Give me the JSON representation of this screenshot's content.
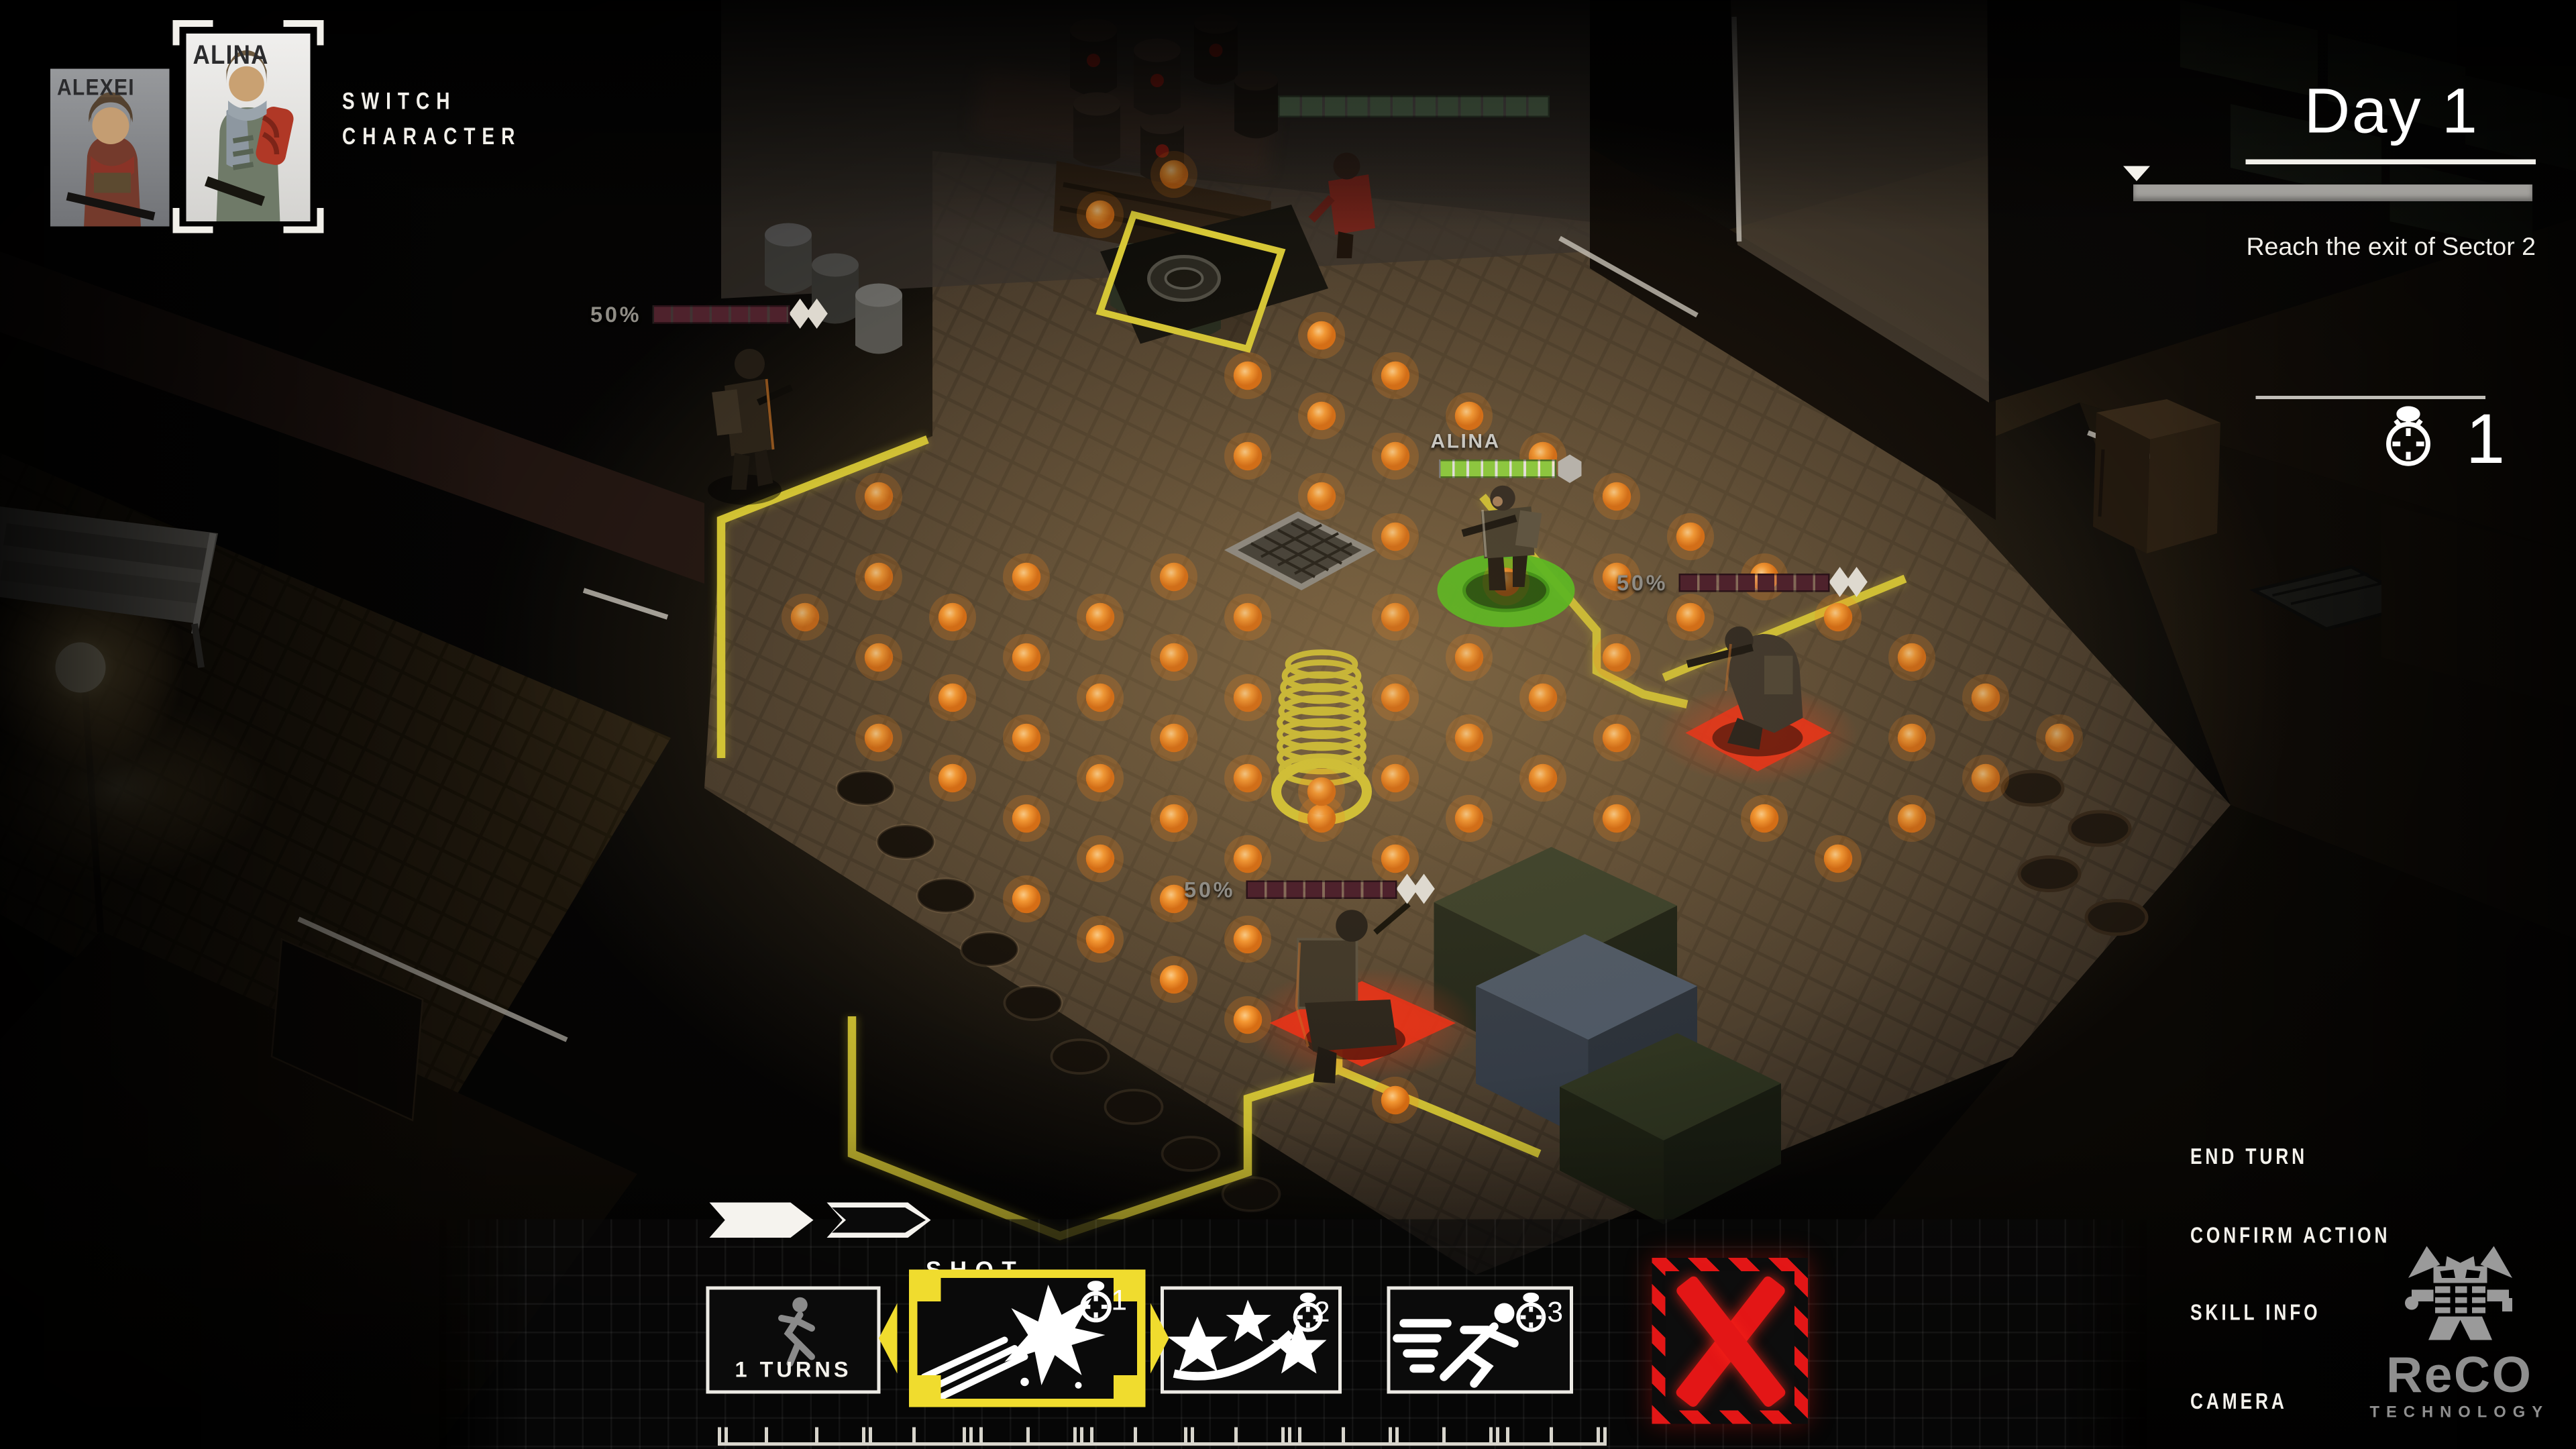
{
  "party": {
    "switch_label_line1": "SWITCH",
    "switch_label_line2": "CHARACTER",
    "members": [
      {
        "name": "ALEXEI",
        "selected": false
      },
      {
        "name": "ALINA",
        "selected": true
      }
    ]
  },
  "mission": {
    "day_label": "Day 1",
    "objective": "Reach the exit of Sector 2",
    "timer_icon": "stopwatch-icon",
    "timer_value": "1",
    "progress_pct": 100
  },
  "skill_bar": {
    "selected_skill_label": "SHOT",
    "move_skill": {
      "label": "1 TURNS",
      "icon": "runner-icon"
    },
    "skills": [
      {
        "icon": "muzzle-flash-icon",
        "cost": "1",
        "selected": true
      },
      {
        "icon": "triple-star-icon",
        "cost": "2",
        "selected": false
      },
      {
        "icon": "sprint-icon",
        "cost": "3",
        "selected": false
      }
    ],
    "cancel_icon": "hazard-x-icon"
  },
  "action_menu": {
    "items": [
      "END TURN",
      "CONFIRM ACTION",
      "SKILL INFO",
      "CAMERA"
    ]
  },
  "brand": {
    "logo_icon": "reco-robot-icon",
    "name": "ReCO",
    "subtitle": "TECHNOLOGY"
  },
  "units": [
    {
      "id": "alina",
      "label": "ALINA",
      "hp_pct": 100,
      "bar_color": "#8dc63f"
    },
    {
      "id": "enemy-top-left",
      "label": "50%",
      "hp_pct": 100,
      "bar_color": "#4e222c"
    },
    {
      "id": "enemy-right",
      "label": "50%",
      "hp_pct": 100,
      "bar_color": "#4e222c"
    },
    {
      "id": "enemy-bottom",
      "label": "50%",
      "hp_pct": 100,
      "bar_color": "#4e222c"
    },
    {
      "id": "ally-top",
      "label": "",
      "hp_pct": 100,
      "bar_color": "rgba(104,150,108,0.4)"
    }
  ],
  "colors": {
    "zone_border": "#d9ca35",
    "selection_yellow": "#f0dc2e",
    "move_dot": "#ff8a18",
    "danger_red": "#e31616",
    "hp_green": "#8dc63f",
    "hp_enemy": "#4e222c"
  },
  "scene": {
    "move_grid": {
      "origin": [
        656,
        128
      ],
      "step_a": [
        44,
        24
      ],
      "step_b": [
        44,
        -24
      ],
      "u_range": [
        0,
        13
      ],
      "v_range": [
        -9,
        6
      ],
      "quad": [
        [
          700,
          96
        ],
        [
          1290,
          478
        ],
        [
          820,
          752
        ],
        [
          442,
          378
        ]
      ],
      "holes": [
        [
          726,
          298,
          96,
          60
        ],
        [
          850,
          322,
          96,
          56
        ],
        [
          756,
          380,
          64,
          104
        ],
        [
          838,
          492,
          224,
          216
        ],
        [
          996,
          408,
          100,
          56
        ],
        [
          748,
          578,
          126,
          62
        ],
        [
          768,
          534,
          84,
          52
        ],
        [
          650,
          116,
          130,
          100
        ],
        [
          1014,
          352,
          80,
          60
        ],
        [
          866,
          286,
          60,
          44
        ],
        [
          556,
          160,
          170,
          180
        ]
      ],
      "extra_dots": [
        [
          788,
          472
        ],
        [
          898,
          347
        ],
        [
          656,
          128
        ]
      ]
    },
    "ruler_ticks": [
      0,
      4,
      28,
      58,
      86,
      90,
      116,
      146,
      150,
      156,
      184,
      212,
      216,
      222,
      248,
      278,
      282,
      308,
      336,
      340,
      346,
      372,
      400,
      404,
      432,
      460,
      464,
      470,
      496,
      524,
      528
    ]
  }
}
